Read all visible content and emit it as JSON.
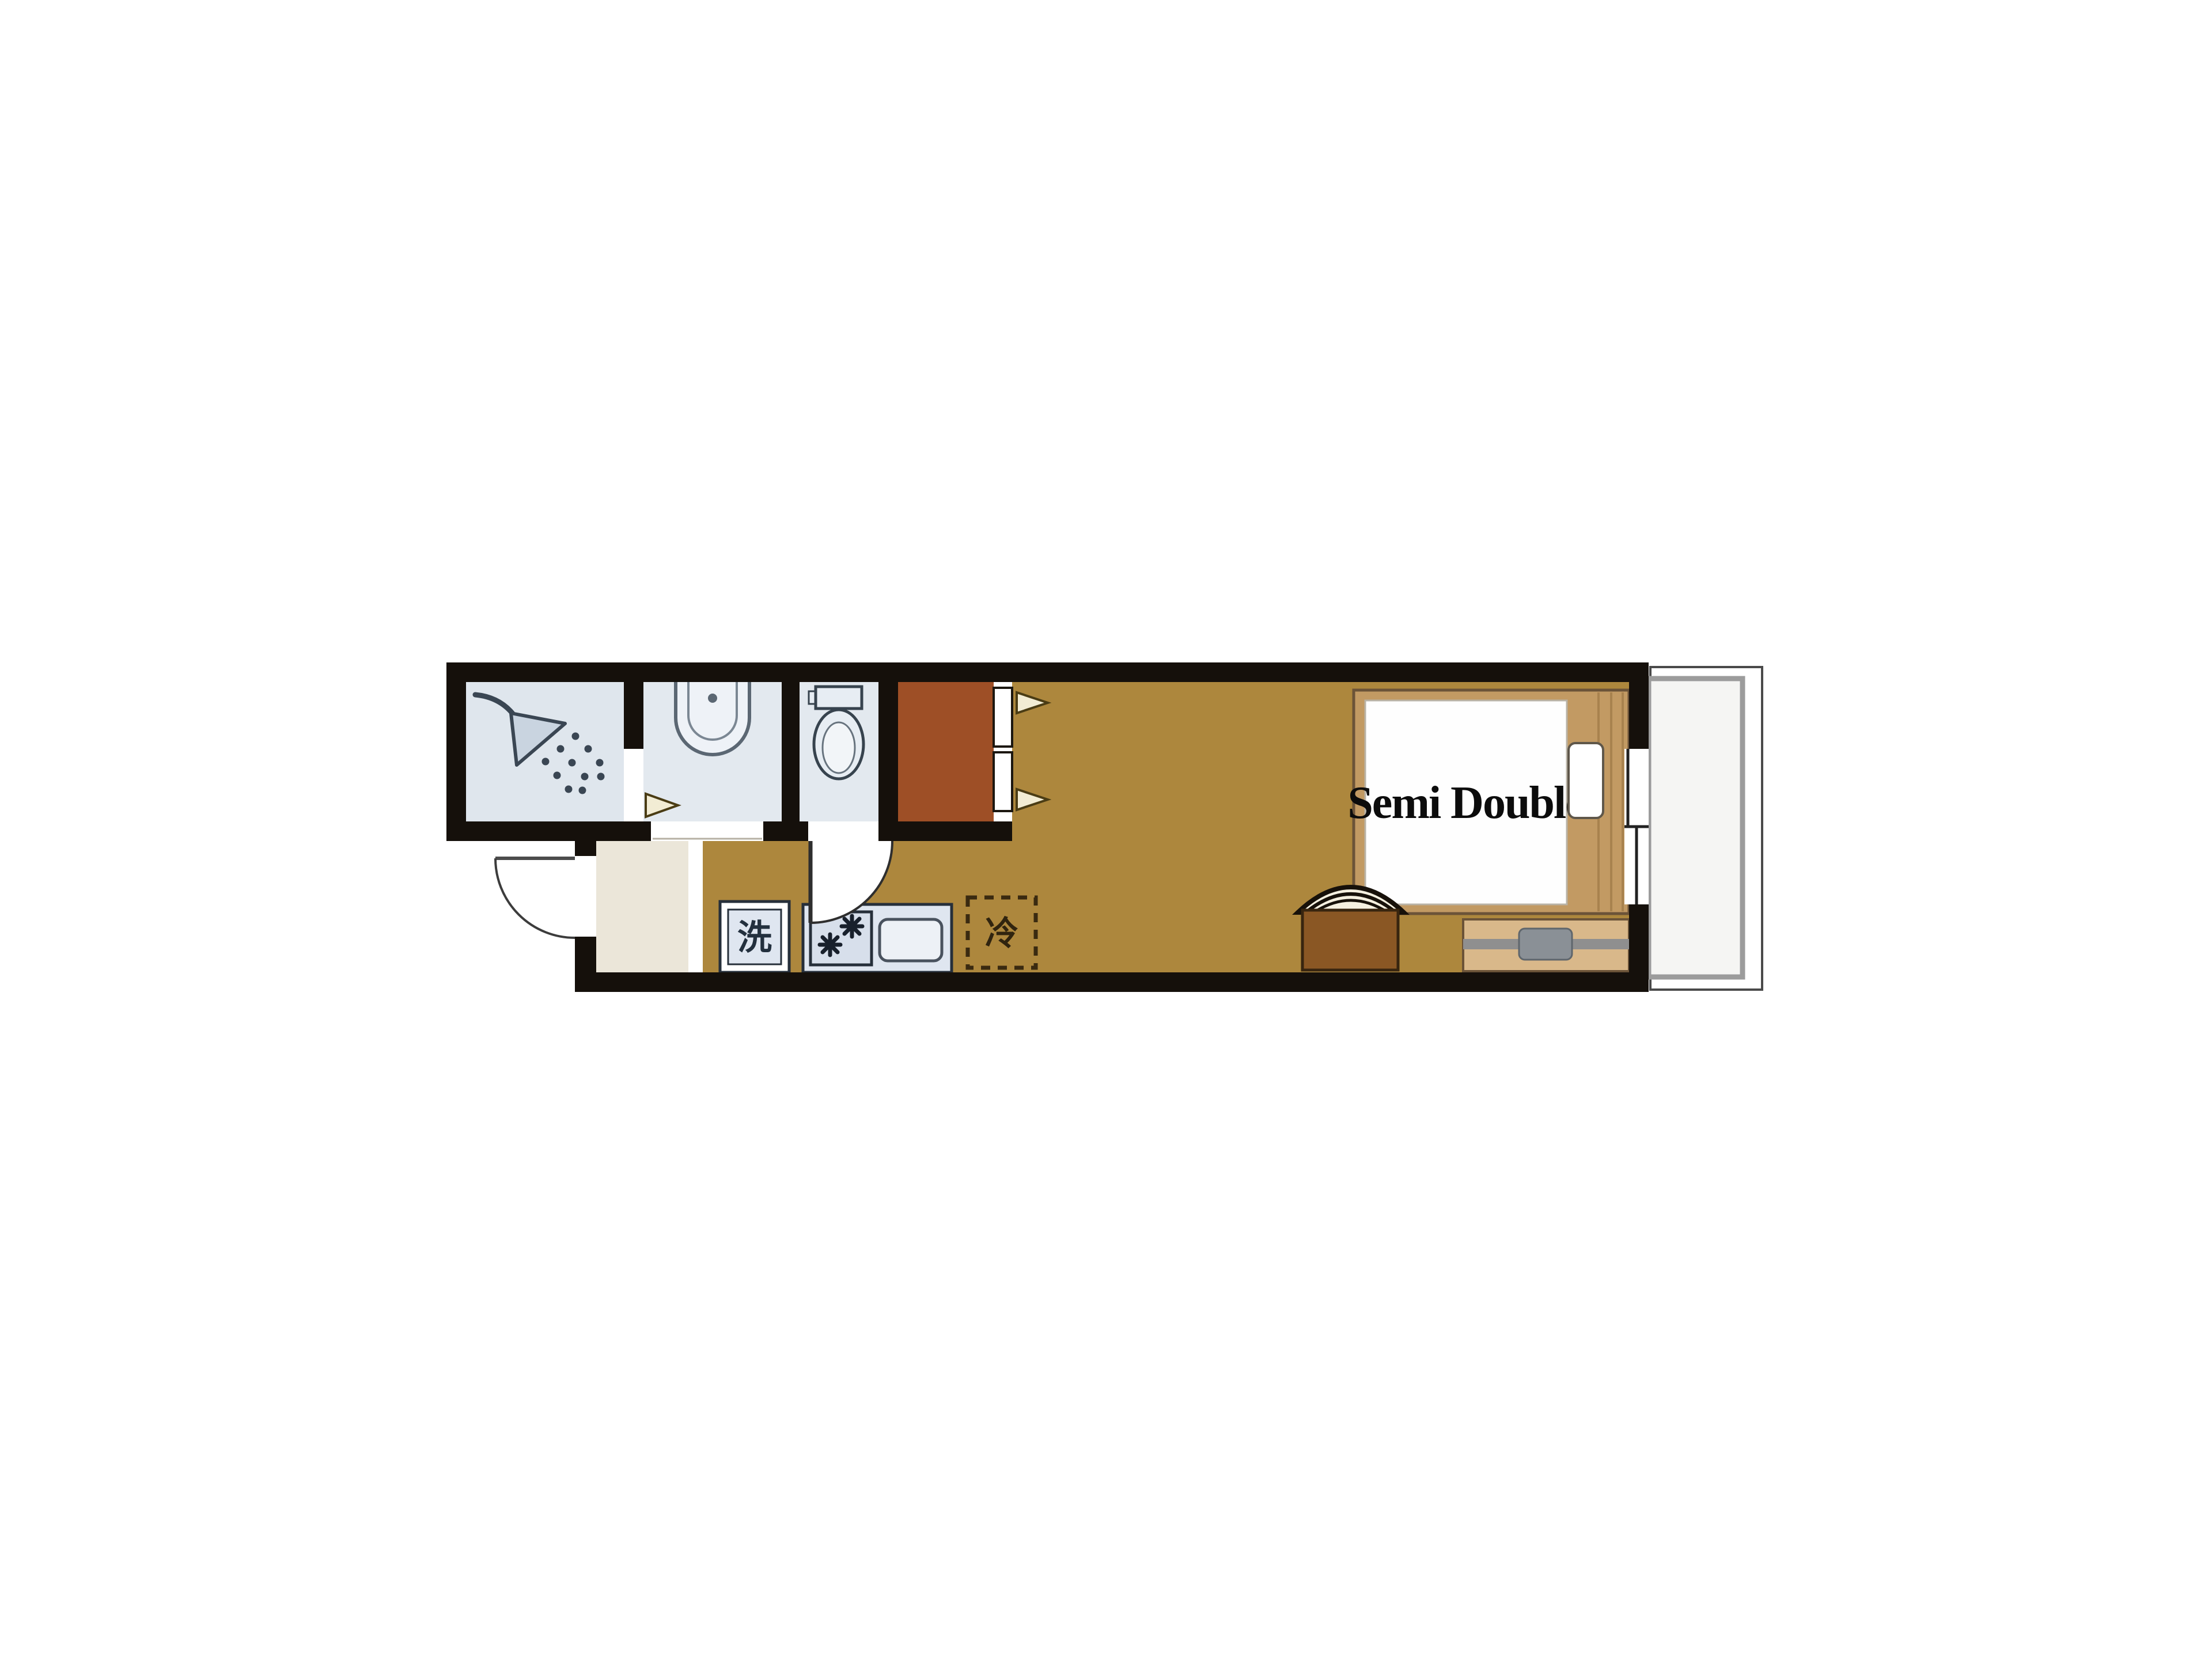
{
  "floorplan": {
    "bed_label": "Semi Double",
    "washer_label": "洗",
    "fridge_label": "冷",
    "colors": {
      "wall": "#15100b",
      "room_floor": "#ad873d",
      "closet_floor": "#9e4f26",
      "wet_area_floor": "#dfe6ed",
      "entry_floor": "#ebe6d9",
      "bed_frame": "#c29a63",
      "mattress": "#fefefe",
      "pillow": "#ffffff",
      "chair_seat": "#8a5724",
      "tv_board": "#d9b88a",
      "tv_gray": "#8a9096",
      "balcony_floor": "#f5f5f3",
      "balcony_inner_border": "#9c9c9c",
      "balcony_outer_border": "#4a4a4a",
      "appliance_fill": "#dfe6f0",
      "icon_stroke": "#3a4653",
      "arrow_fill": "#f2ecd4",
      "arrow_stroke": "#4a3c14"
    }
  }
}
